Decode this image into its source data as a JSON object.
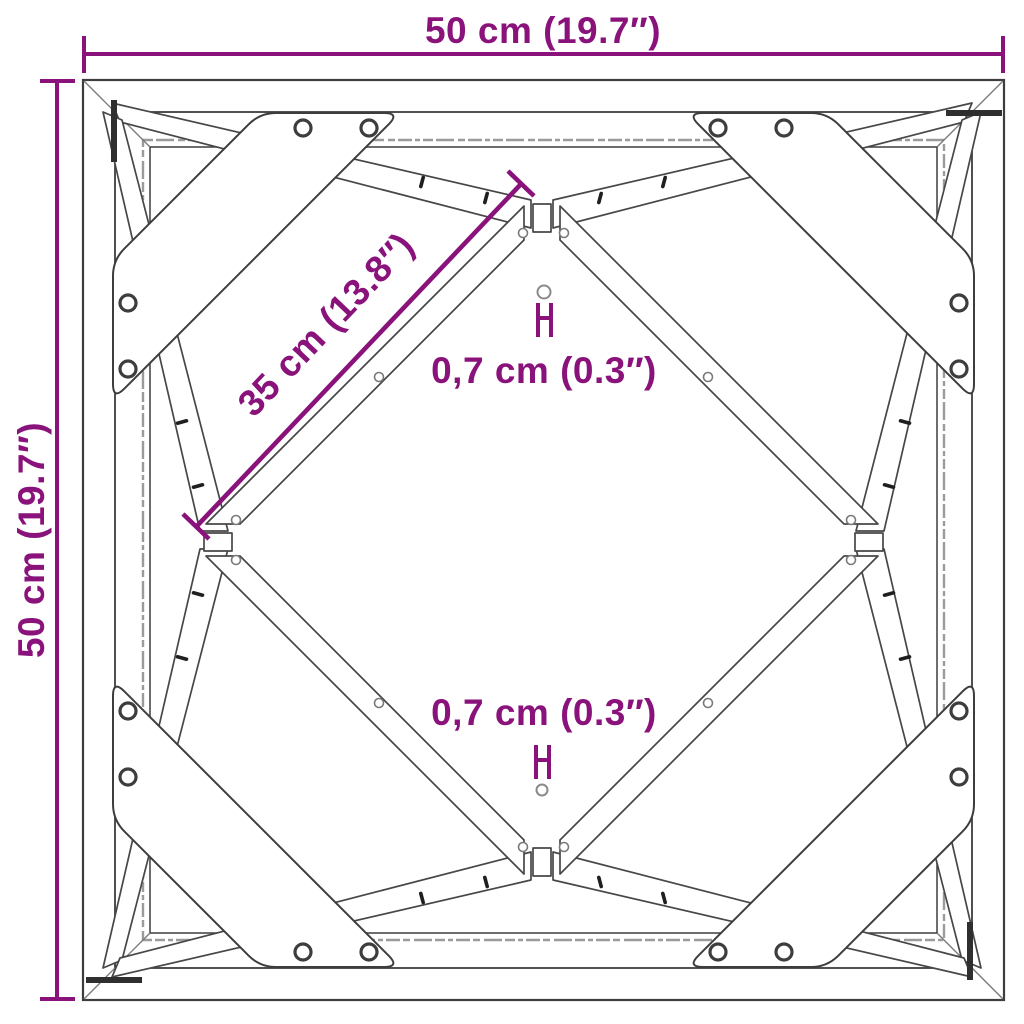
{
  "diagram": {
    "type": "product-dimension-drawing",
    "subject": "square metal frame, top view, with corner gussets and diagonal braces",
    "colors": {
      "dimension_accent": "#8A127B",
      "line_dark": "#3d3d3d",
      "line_light": "#9b9b9b",
      "background": "#ffffff"
    },
    "dimensions": {
      "width_label": "50 cm (19.7″)",
      "height_label": "50 cm (19.7″)",
      "diagonal_label": "35 cm (13.8″)",
      "hole_top_label": "0,7 cm (0.3″)",
      "hole_bottom_label": "0,7 cm (0.3″)"
    }
  }
}
